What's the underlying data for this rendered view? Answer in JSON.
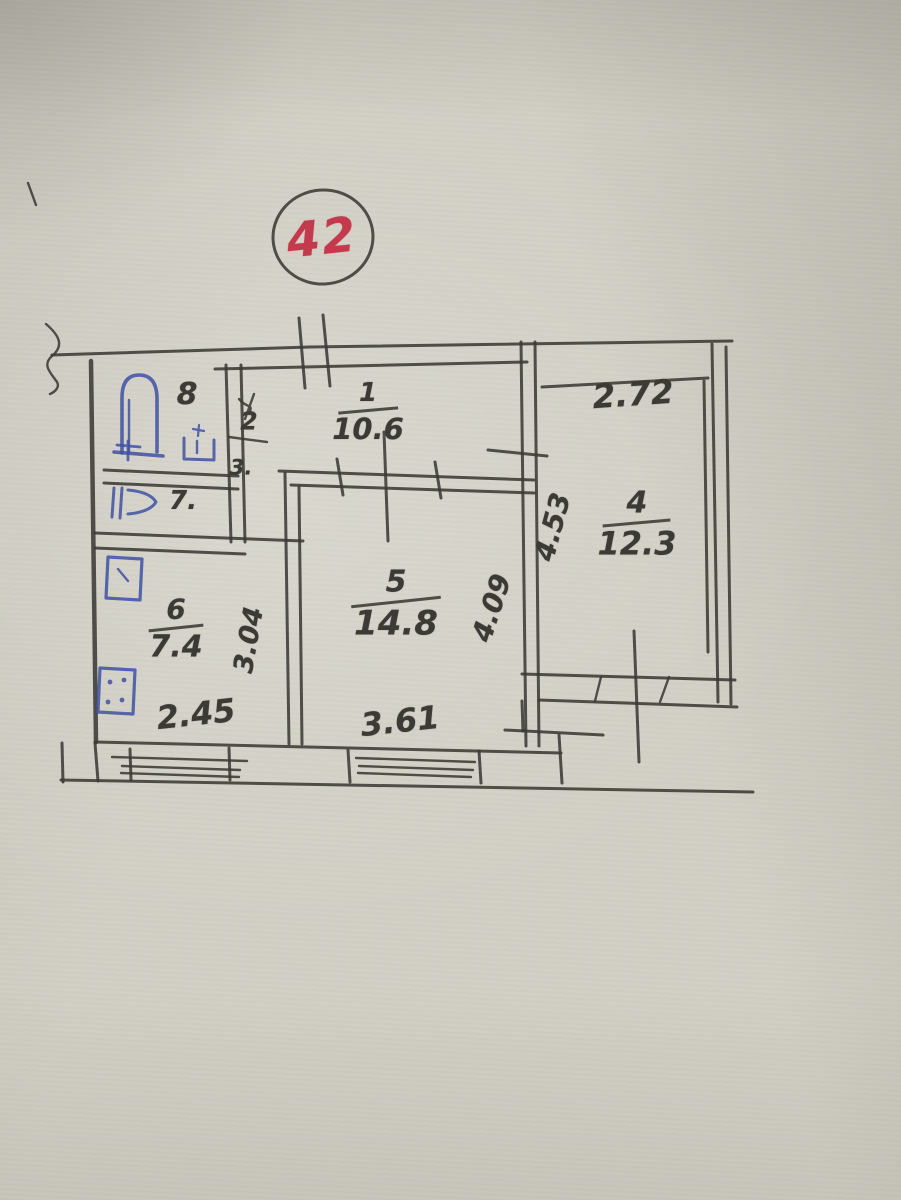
{
  "stamp": {
    "number": "42"
  },
  "rooms": {
    "hallway": {
      "number": "1",
      "area": "10.6"
    },
    "room4": {
      "number": "4",
      "area": "12.3"
    },
    "room5": {
      "number": "5",
      "area": "14.8"
    },
    "kitchen": {
      "number": "6",
      "area": "7.4"
    },
    "bathroom": {
      "number": "8"
    },
    "closet2": {
      "number": "2"
    },
    "closet3": {
      "number": "3."
    },
    "toilet": {
      "number": "7."
    }
  },
  "dimensions": {
    "room4_top_width": "2.72",
    "kitchen_bottom_width": "2.45",
    "room5_bottom_width": "3.61",
    "kitchen_depth_vertical": "3.04",
    "room5_depth_vertical": "4.09",
    "room4_depth_vertical": "4.53"
  },
  "colors": {
    "paper": "#d2d0c5",
    "pencil": "#3b3a34",
    "fixture_blue": "#3f51a3",
    "stamp_red": "#c23a4c"
  }
}
